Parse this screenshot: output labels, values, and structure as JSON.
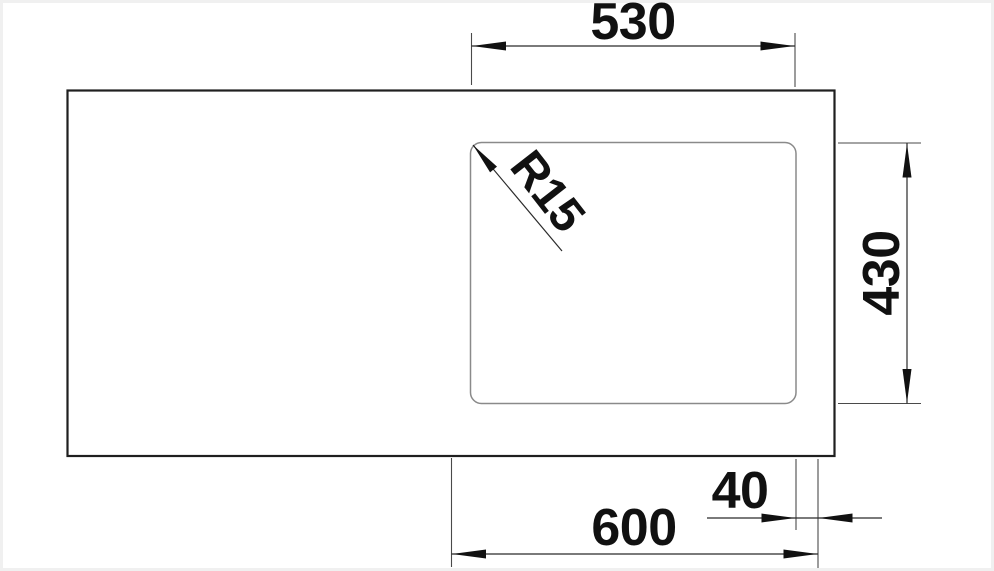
{
  "drawing": {
    "kind": "sink-top-view-dimension-drawing",
    "dimensions": {
      "bowl_width": {
        "label": "530"
      },
      "bowl_depth": {
        "label": "430"
      },
      "cabinet_width": {
        "label": "600"
      },
      "edge_offset": {
        "label": "40"
      },
      "corner_radius": {
        "label": "R15"
      }
    },
    "colors": {
      "background": "#ffffff",
      "frame_edge": "#f0f0f0",
      "sink_outline": "#1f1f1f",
      "bowl_outline": "#8a8a8a",
      "dimension_line": "#2a2a2a",
      "text": "#111111"
    }
  }
}
